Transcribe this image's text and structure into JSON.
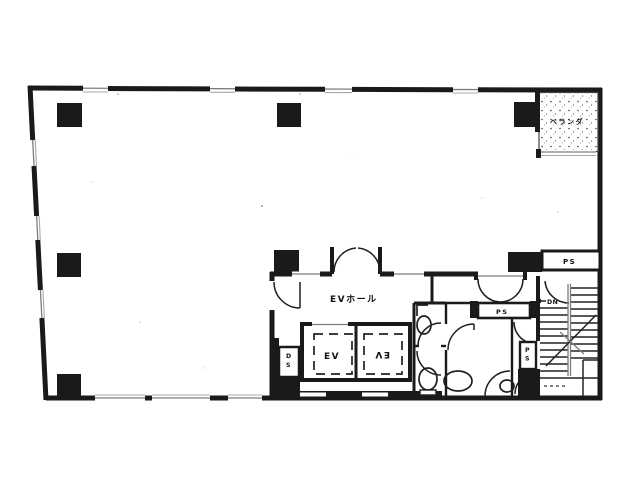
{
  "figure": {
    "kind": "architectural floor plan (scanned, black and white)"
  },
  "colors": {
    "ink": "#1a1a1a",
    "paper": "#ffffff",
    "window_line": "#7d7d7d"
  },
  "labels": {
    "balcony": "ベランダ",
    "ev_hall": "EVホール",
    "elevator_left": "EV",
    "elevator_right": "EV",
    "ps_upper_right": "PS",
    "ps_center": "PS",
    "ps_stairwell": "PS",
    "duct_shaft": "DS",
    "stairs_down": "DN"
  }
}
